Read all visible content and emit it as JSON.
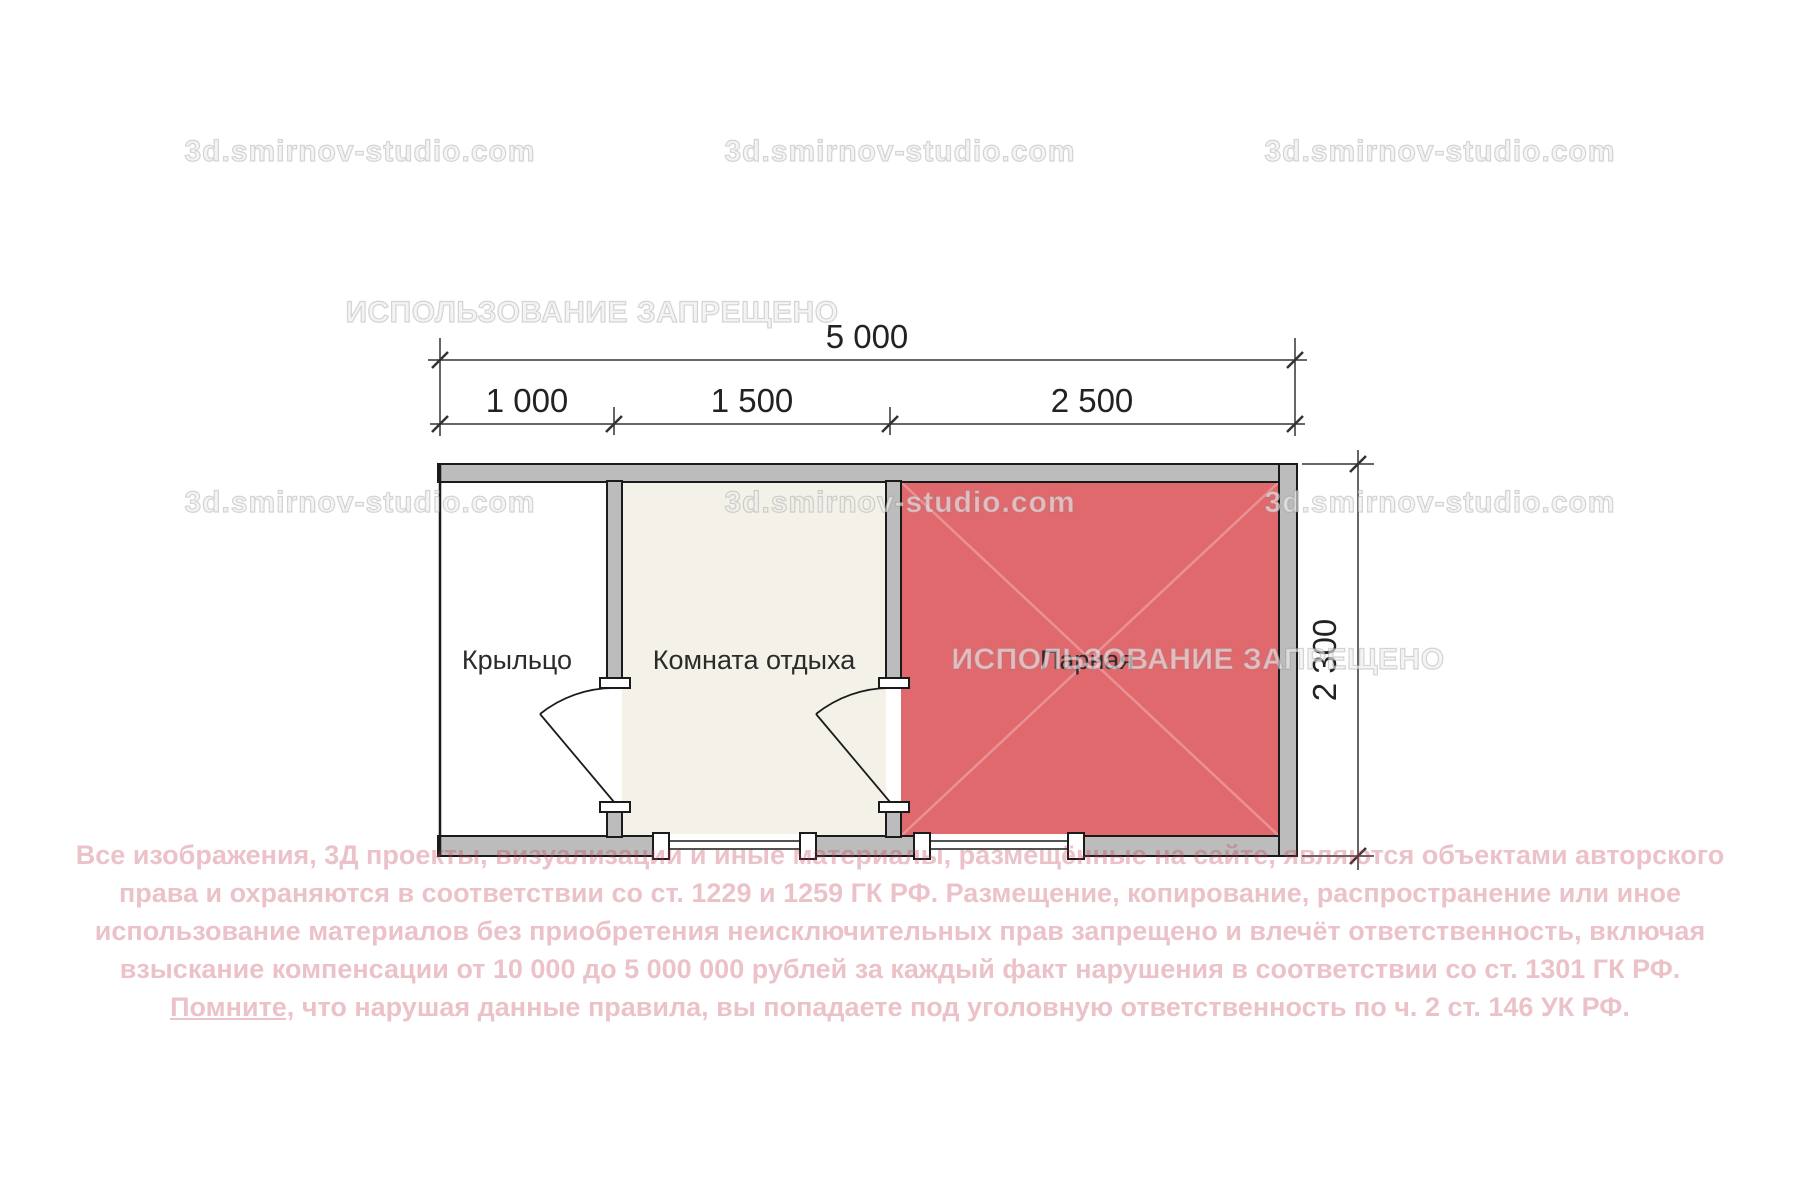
{
  "plan": {
    "wall_color": "#bcbcbc",
    "outline_color": "#1b1b1b",
    "rooms": [
      {
        "label": "Крыльцо",
        "fill": "#ffffff"
      },
      {
        "label": "Комната отдыха",
        "fill": "#f4f1e8"
      },
      {
        "label": "Парная",
        "fill": "#e0696e"
      }
    ],
    "dimensions": {
      "total_width": "5 000",
      "segments": [
        "1 000",
        "1 500",
        "2 500"
      ],
      "height": "2 300"
    }
  },
  "watermarks": {
    "site": "3d.smirnov-studio.com",
    "ban": "ИСПОЛЬЗОВАНИЕ ЗАПРЕЩЕНО"
  },
  "copyright": {
    "line1": "Все изображения, 3Д проекты, визуализации и иные материалы, размещённые на сайте, являются объектами авторского",
    "line2": "права и охраняются в соответствии со ст. 1229 и 1259 ГК РФ. Размещение, копирование, распространение или иное",
    "line3": "использование материалов без приобретения неисключительных прав запрещено и влечёт ответственность, включая",
    "line4": "взыскание компенсации от 10 000 до 5 000 000 рублей за каждый факт нарушения в соответствии со ст. 1301 ГК РФ.",
    "line5_underlined": "Помните,",
    "line5_rest": " что нарушая данные правила, вы попадаете под уголовную ответственность по ч. 2 ст. 146 УК РФ."
  }
}
